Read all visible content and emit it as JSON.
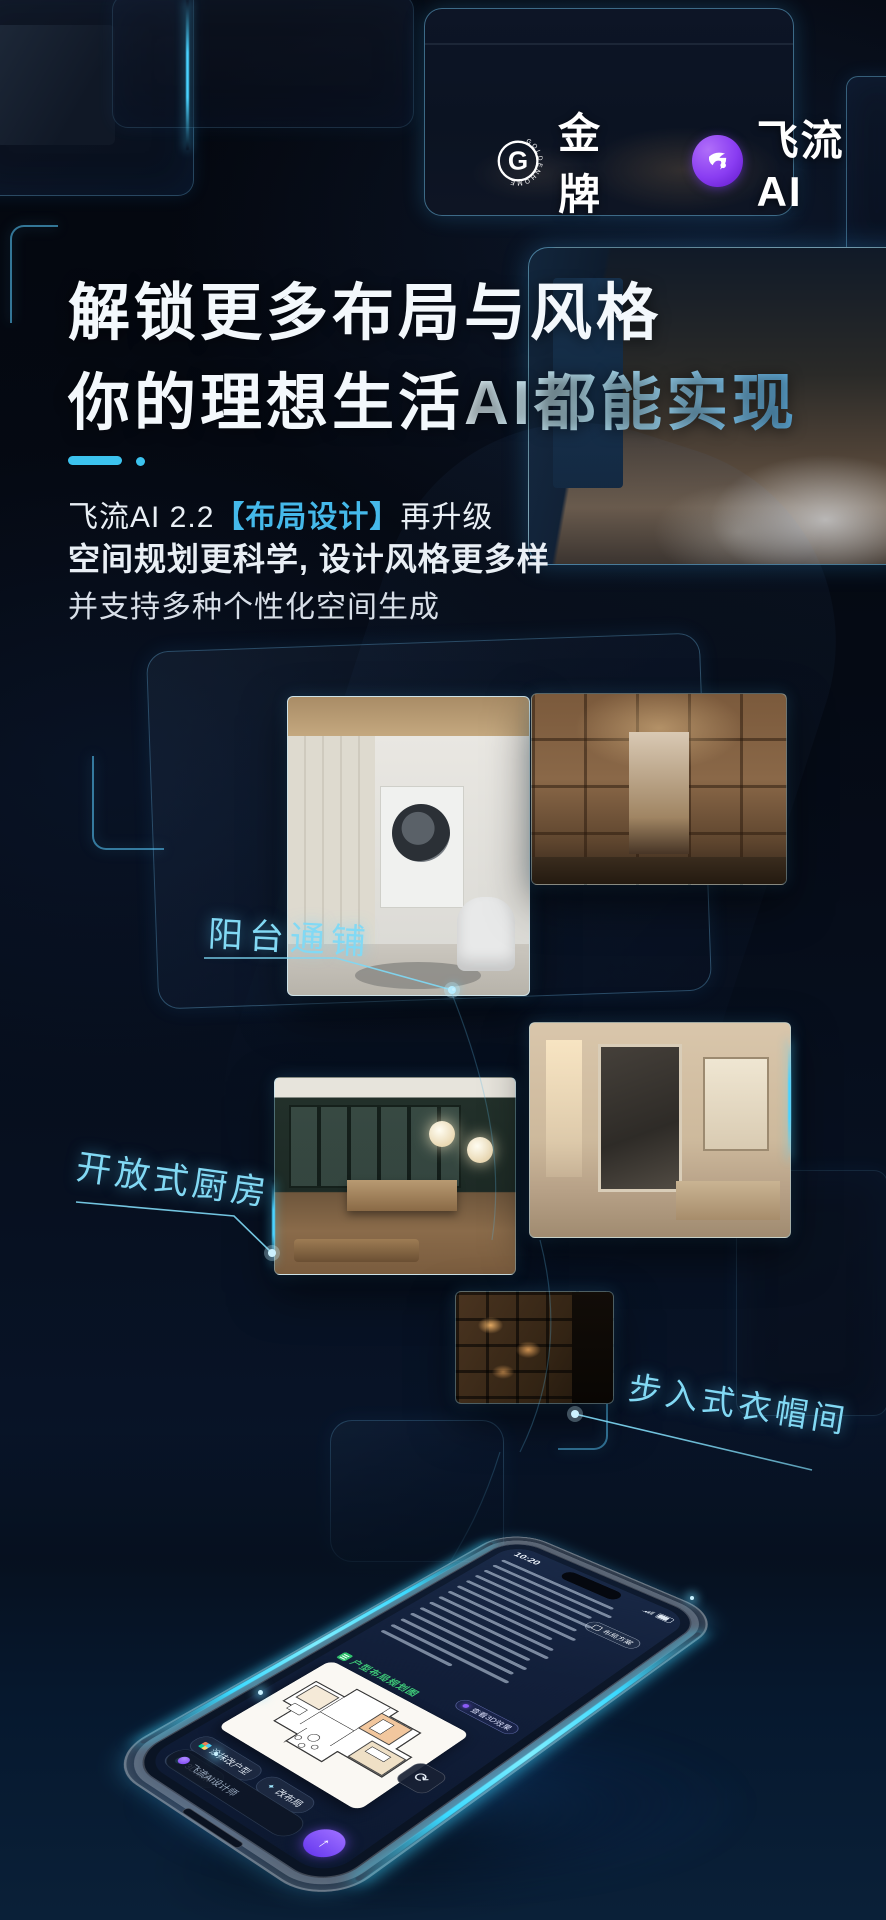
{
  "header": {
    "goldenhome_logo_letter": "G",
    "goldenhome_logo_ring_text": "GOLDENHOME",
    "goldenhome_name": "金牌",
    "feiliu_name": "飞流AI"
  },
  "hero": {
    "title_line1": "解锁更多布局与风格",
    "title_line2_prefix": "你的理想生活",
    "title_line2_accent": "AI都能实现",
    "sub_line1_prefix": "飞流AI 2.2",
    "sub_line1_accent": "【布局设计】",
    "sub_line1_suffix": "再升级",
    "sub_line2": "空间规划更科学, 设计风格更多样",
    "sub_line3": "并支持多种个性化空间生成"
  },
  "callouts": {
    "balcony": "阳台通铺",
    "kitchen": "开放式厨房",
    "closet": "步入式衣帽间"
  },
  "phone_ui": {
    "status_time": "10:20",
    "plan_badge": "布局方案",
    "result_label": "户型布局规划图",
    "view_pill": "查看3D效果",
    "chip_repaint": "涂抹改户型",
    "chip_layout": "改布局",
    "chip_3d": "3D效果",
    "input_text": "飞流AI设计师"
  },
  "icons": {
    "send_arrow": "↑",
    "refresh": "⟳",
    "wand": "✦"
  },
  "colors": {
    "accent_cyan": "#4fc9f2",
    "accent_deep": "#2496cf",
    "logo_purple": "#8a3df2",
    "success_green": "#35c06a",
    "background": "#04070e",
    "led_glow": "#3ad9ff"
  }
}
